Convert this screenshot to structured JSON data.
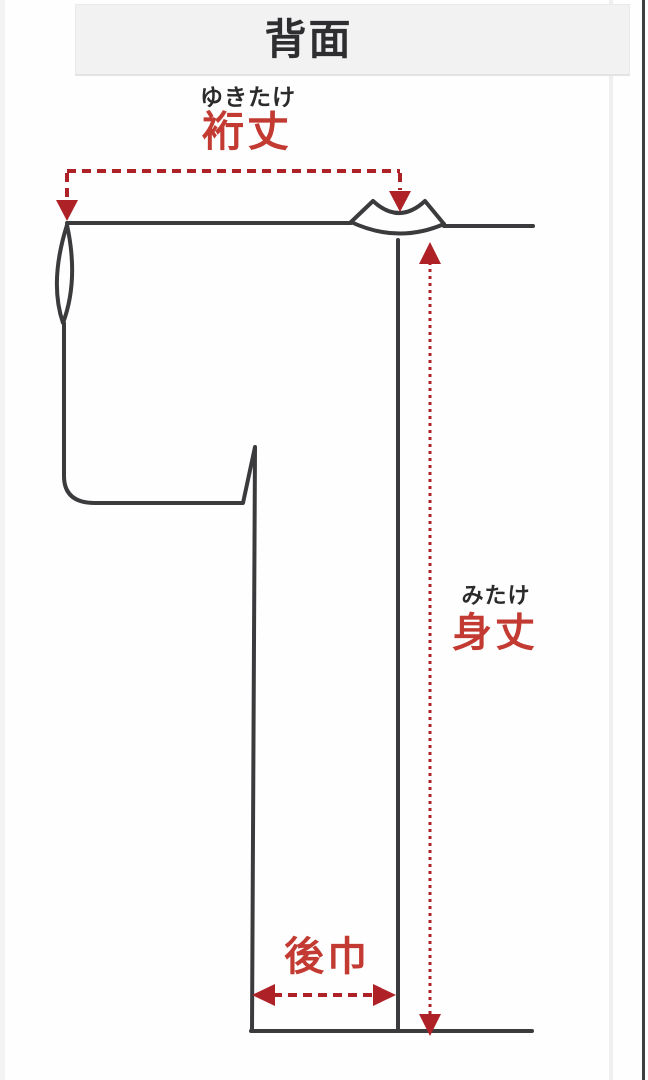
{
  "header": {
    "title": "背面"
  },
  "labels": {
    "yukitake": {
      "furigana": "ゆきたけ",
      "kanji": "裄丈"
    },
    "mitake": {
      "furigana": "みたけ",
      "kanji": "身丈"
    },
    "ushirohaba": {
      "kanji": "後巾"
    }
  },
  "measurements": [
    {
      "label": "裄丈",
      "furigana": "ゆきたけ",
      "axis": "horizontal",
      "line_style": "dashed",
      "described_span": "sleeve end to center back collar"
    },
    {
      "label": "身丈",
      "furigana": "みたけ",
      "axis": "vertical",
      "line_style": "dotted",
      "described_span": "below collar to hem"
    },
    {
      "label": "後巾",
      "axis": "horizontal",
      "line_style": "dashed",
      "described_span": "side seam to center back at hem"
    }
  ],
  "icons": {
    "arrow_down": "▼",
    "arrow_up": "▲",
    "arrow_left": "◀",
    "arrow_right": "▶"
  },
  "colors": {
    "outline": "#3b3b3d",
    "measure_red": "#ae2126",
    "label_red": "#c23a31",
    "furigana_black": "#2b2b2b",
    "header_bg": "#f2f2f3",
    "header_text": "#2e2e30",
    "background": "#ffffff"
  }
}
